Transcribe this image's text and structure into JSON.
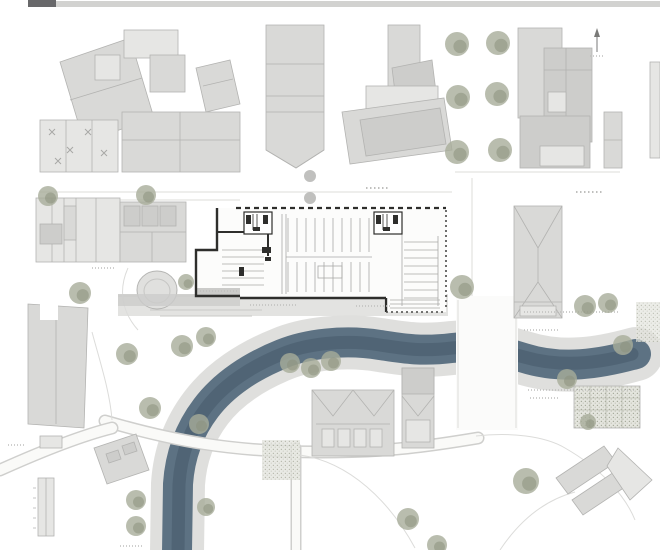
{
  "sheet": {
    "kind": "architectural-site-plan",
    "header_bar": {
      "label": ""
    }
  },
  "palette": {
    "background": "#ffffff",
    "bar": "#d2d2d0",
    "bar_label": "#68686a",
    "building_fill": "#d9d9d7",
    "building_light": "#e6e6e4",
    "building_dark": "#cdcdcb",
    "building_edge": "#b3b3b1",
    "plan_wall": "#2e2e2c",
    "plan_line": "#a9a9a7",
    "annotation": "#bfbfbd",
    "paving": "#dddddb",
    "paving_dark": "#c8c8c6",
    "river": "#5d7283",
    "river_deep": "#46596a",
    "tree": "#a8ac9a",
    "tree_deep": "#8d927e",
    "street_tree": "#b9b9b7",
    "road": "#fafaf8",
    "road_edge": "#cfcfcd",
    "stipple_bg": "#e4e5de",
    "stipple_dot": "#a6a99a"
  },
  "layers": [
    "paving",
    "river",
    "roads",
    "existing-buildings",
    "floor-plan",
    "trees",
    "annotations"
  ],
  "trees": {
    "green": [
      [
        48,
        196,
        10
      ],
      [
        146,
        195,
        10
      ],
      [
        457,
        44,
        12
      ],
      [
        498,
        43,
        12
      ],
      [
        458,
        97,
        12
      ],
      [
        497,
        94,
        12
      ],
      [
        457,
        152,
        12
      ],
      [
        500,
        150,
        12
      ],
      [
        80,
        293,
        11
      ],
      [
        186,
        282,
        8
      ],
      [
        127,
        354,
        11
      ],
      [
        182,
        346,
        11
      ],
      [
        206,
        337,
        10
      ],
      [
        290,
        363,
        10
      ],
      [
        311,
        368,
        10
      ],
      [
        331,
        361,
        10
      ],
      [
        150,
        408,
        11
      ],
      [
        199,
        424,
        10
      ],
      [
        462,
        287,
        12
      ],
      [
        585,
        306,
        11
      ],
      [
        608,
        303,
        10
      ],
      [
        623,
        345,
        10
      ],
      [
        567,
        379,
        10
      ],
      [
        588,
        422,
        8
      ],
      [
        136,
        500,
        10
      ],
      [
        136,
        526,
        10
      ],
      [
        206,
        507,
        9
      ],
      [
        526,
        481,
        13
      ],
      [
        408,
        519,
        11
      ],
      [
        437,
        545,
        10
      ]
    ],
    "street": [
      [
        310,
        176,
        6
      ],
      [
        310,
        198,
        6
      ]
    ]
  }
}
